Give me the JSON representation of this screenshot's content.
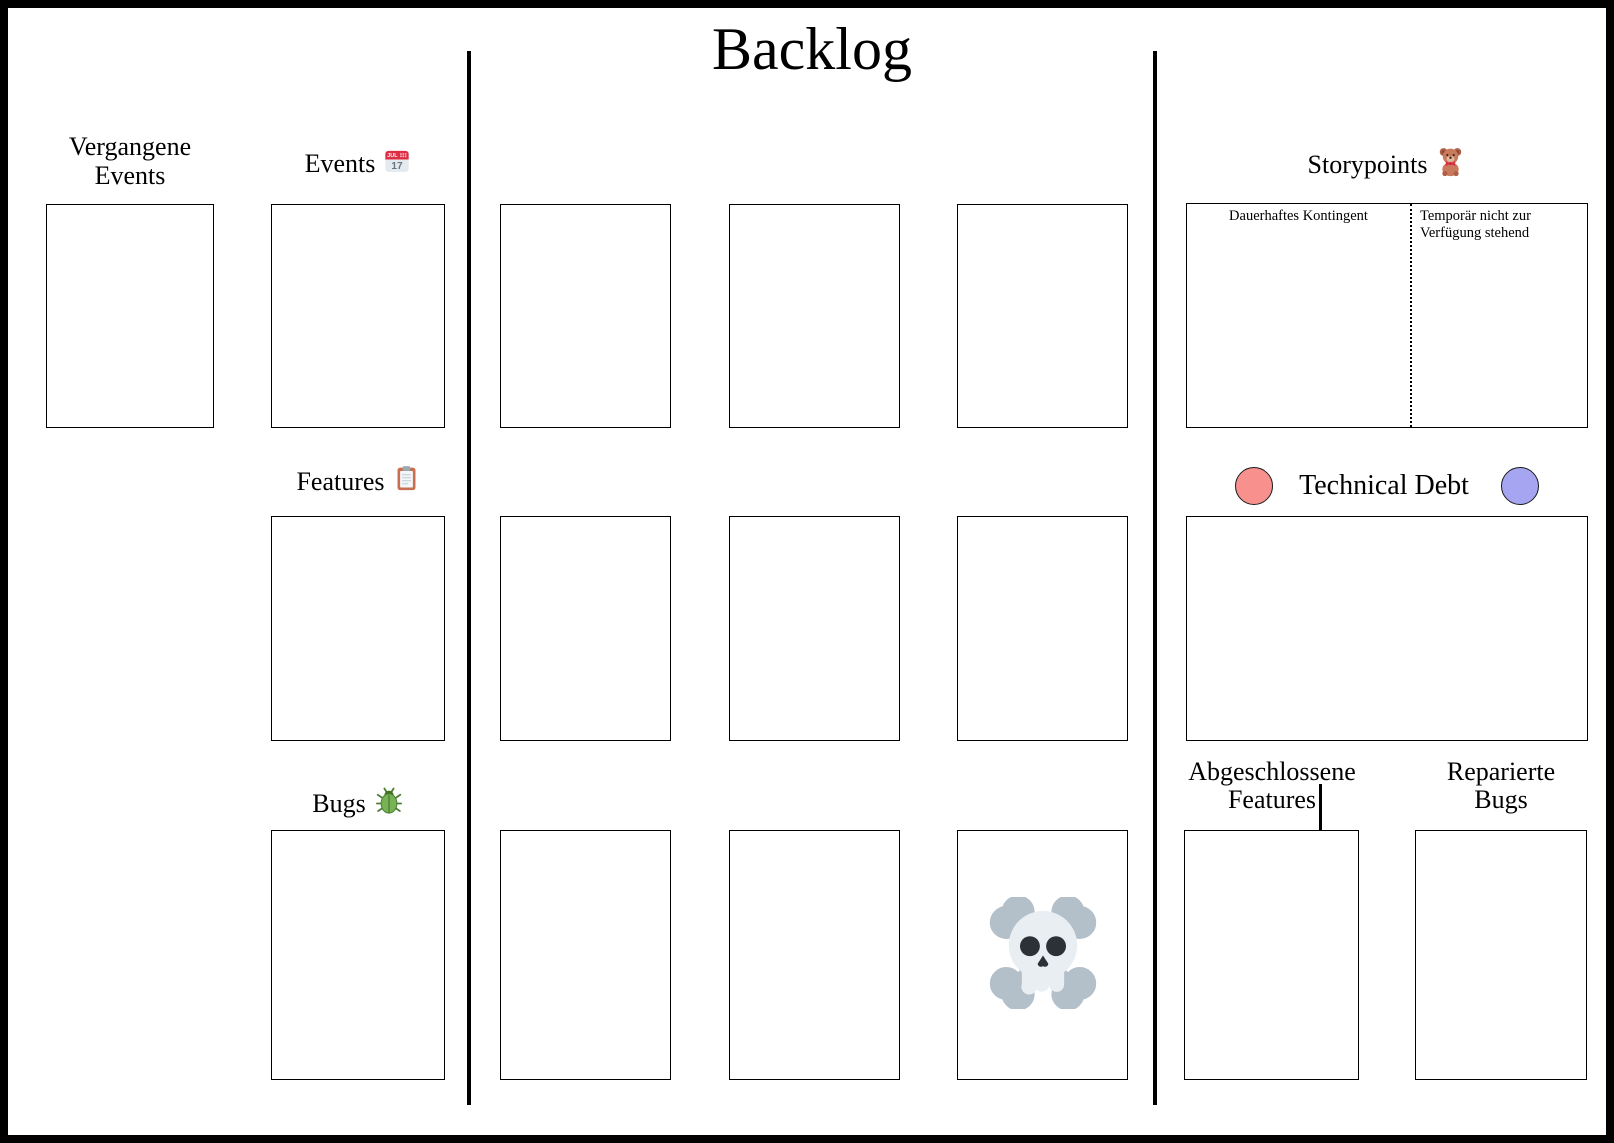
{
  "board": {
    "title": "Backlog",
    "colors": {
      "frame": "#000000",
      "line": "#000000",
      "background": "#ffffff",
      "technical_debt_red_token": "#f8918e",
      "technical_debt_purple_token": "#a5a5f1"
    },
    "left": {
      "past_events_label": [
        "Vergangene",
        "Events"
      ],
      "events_label": "Events",
      "calendar_month": "JUL",
      "calendar_day": "17",
      "features_label": "Features",
      "bugs_label": "Bugs"
    },
    "center": {
      "card_slot_count": 9,
      "skull_slot": "row 3, column 3"
    },
    "right": {
      "storypoints_label": "Storypoints",
      "storypoints_left_zone_label": "Dauerhaftes Kontingent",
      "storypoints_right_zone_label": [
        "Temporär nicht zur",
        "Verfügung stehend"
      ],
      "technical_debt_label": "Technical Debt",
      "completed_features_label": [
        "Abgeschlossene",
        "Features"
      ],
      "repaired_bugs_label": [
        "Reparierte",
        "Bugs"
      ]
    },
    "icons": {
      "events": "calendar-icon",
      "features": "clipboard-icon",
      "bugs": "beetle-icon",
      "storypoints": "teddy-bear-icon",
      "danger_card_slot": "skull-crossbones-icon",
      "technical_debt_left": "red-token-circle",
      "technical_debt_right": "purple-token-circle"
    }
  }
}
